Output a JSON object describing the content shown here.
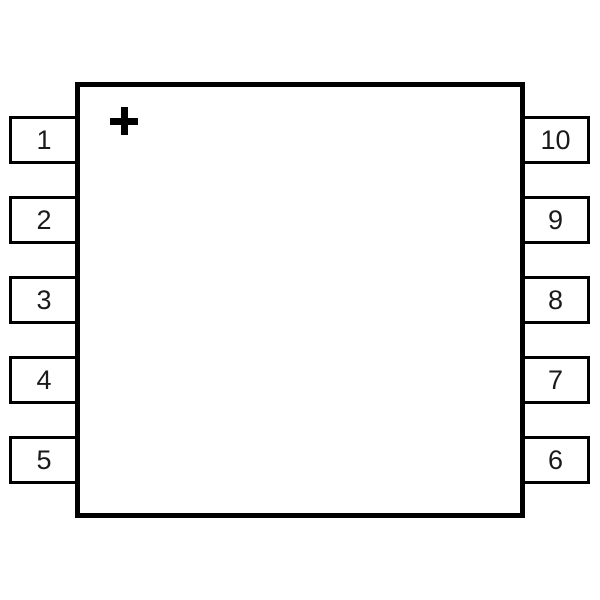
{
  "diagram": {
    "type": "ic-package-pinout",
    "description": "10-pin IC package outline, top view, with pin-1 polarity marker",
    "marker_symbol": "+",
    "colors": {
      "line": "#000000",
      "background": "#ffffff"
    },
    "pins": {
      "left": [
        "1",
        "2",
        "3",
        "4",
        "5"
      ],
      "right": [
        "10",
        "9",
        "8",
        "7",
        "6"
      ]
    }
  }
}
